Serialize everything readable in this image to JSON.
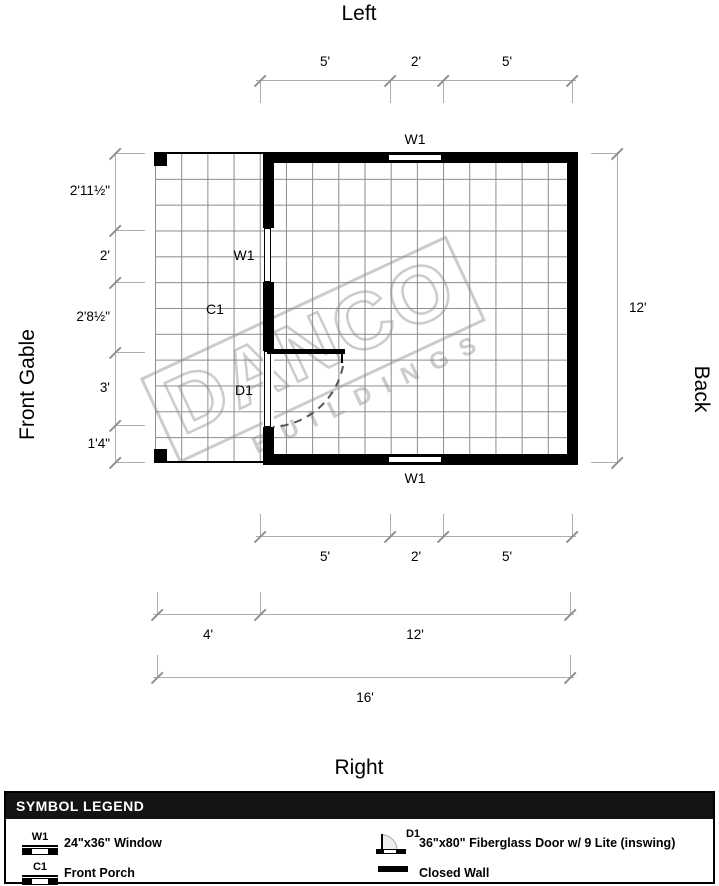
{
  "titles": {
    "top": "Left",
    "bottom": "Right",
    "left_side": "Front Gable",
    "right_side": "Back"
  },
  "dims": {
    "top": [
      "5'",
      "2'",
      "5'"
    ],
    "left": [
      "2'11½\"",
      "2'",
      "2'8½\"",
      "3'",
      "1'4\""
    ],
    "right": "12'",
    "bottom1": [
      "5'",
      "2'",
      "5'"
    ],
    "bottom2": [
      "4'",
      "12'"
    ],
    "bottom3": "16'"
  },
  "plan": {
    "w1_top": "W1",
    "w1_left": "W1",
    "w1_bottom": "W1",
    "c1": "C1",
    "d1": "D1"
  },
  "watermark": {
    "name": "DANCO",
    "sub": "BUILDINGS"
  },
  "legend": {
    "header": "SYMBOL LEGEND",
    "w1": {
      "symbol": "W1",
      "label": "24\"x36\" Window"
    },
    "d1": {
      "symbol": "D1",
      "label": "36\"x80\" Fiberglass Door w/ 9 Lite (inswing)"
    },
    "c1": {
      "symbol": "C1",
      "label": "Front Porch"
    },
    "wall": {
      "label": "Closed Wall"
    }
  },
  "colors": {
    "wall": "#000000",
    "grid": "#8c8c8c",
    "dim_line": "#aeaeae",
    "watermark": "#cccccc",
    "legend_header_bg": "#141414"
  }
}
